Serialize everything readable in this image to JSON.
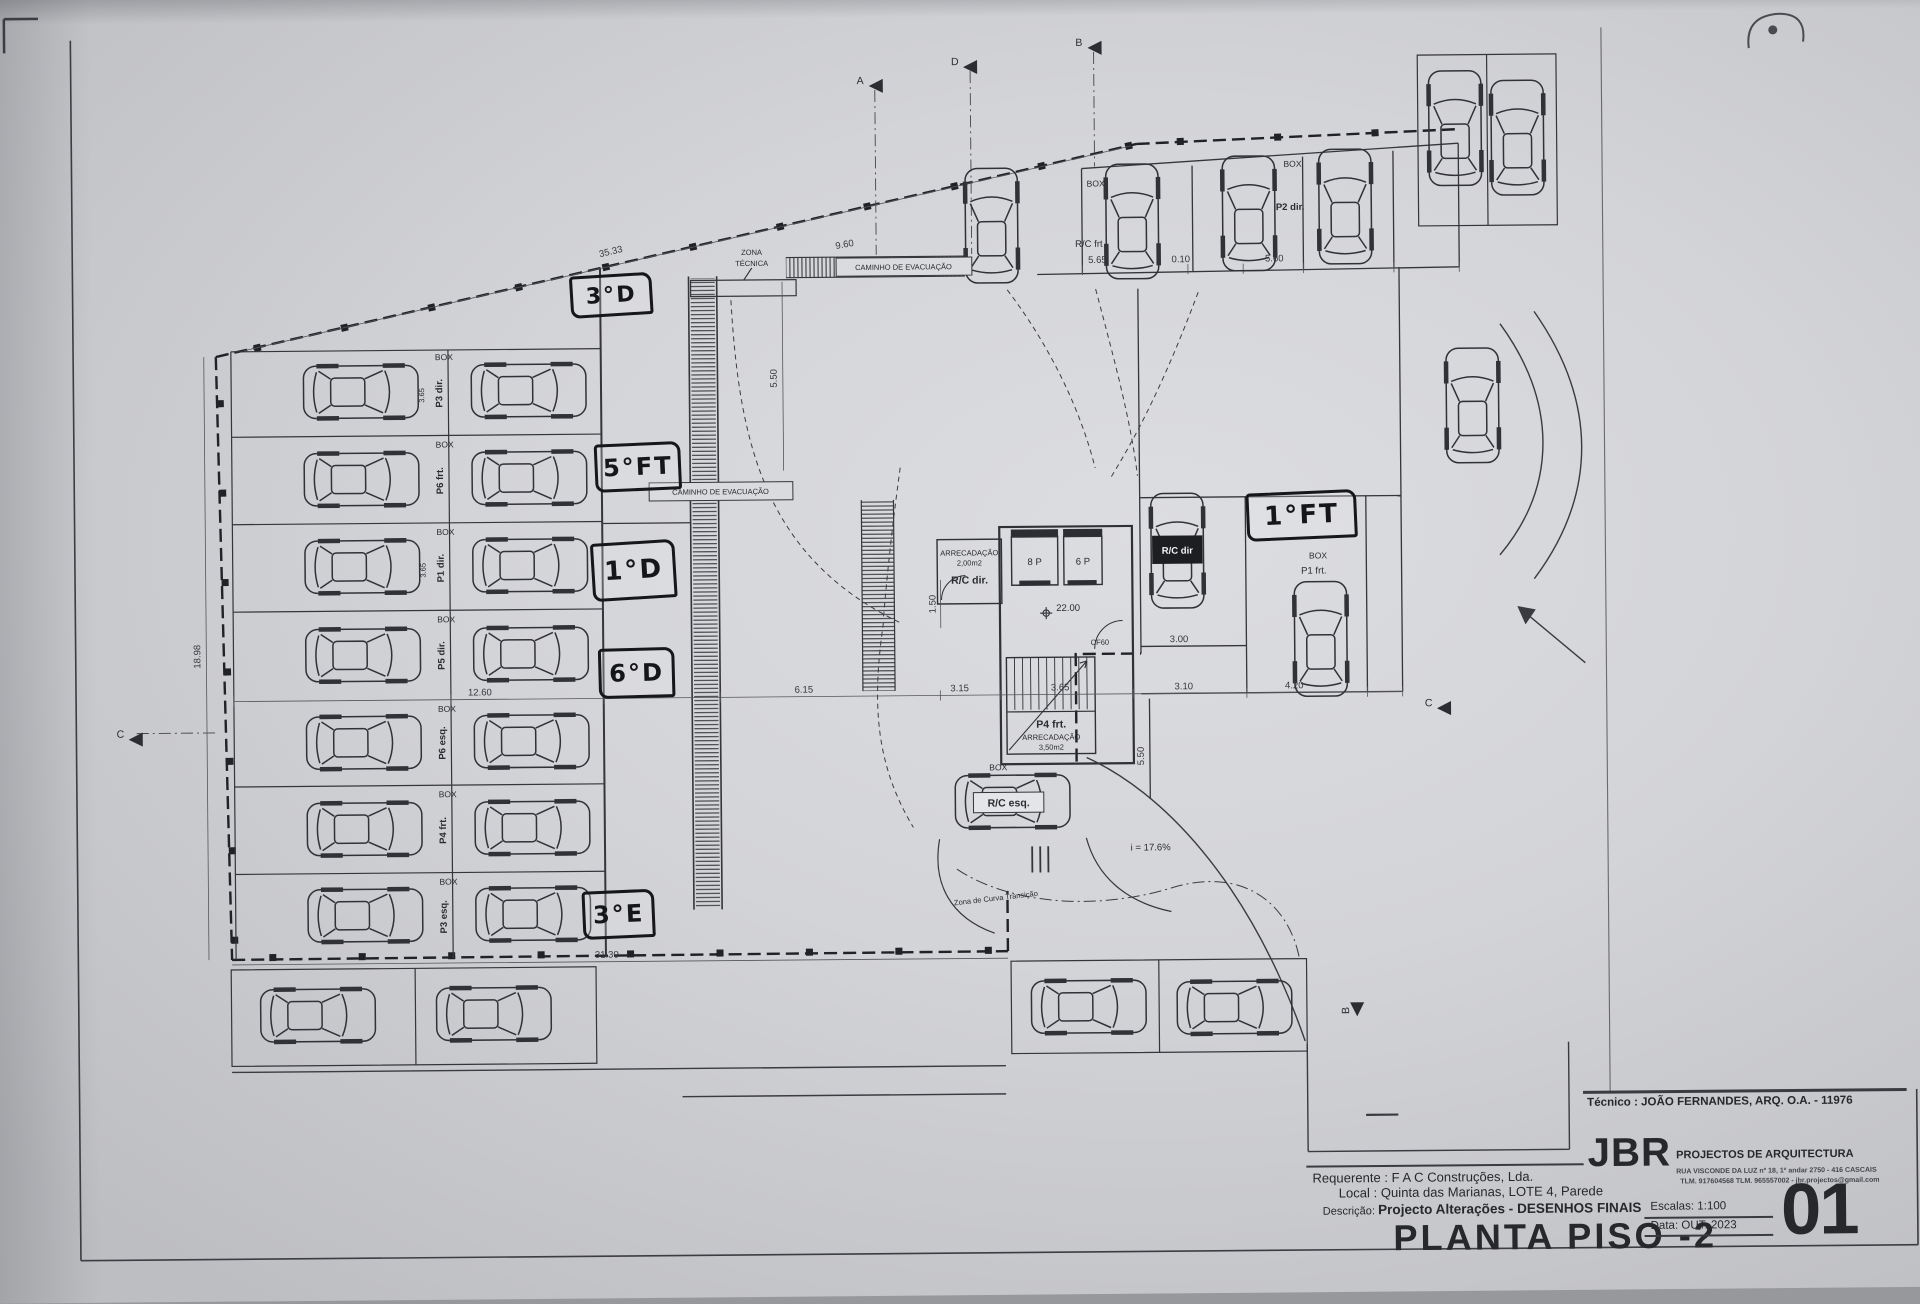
{
  "handwritten": {
    "top": "3°D",
    "mid1": "5°FT",
    "mid2": "1°D",
    "mid3": "6°D",
    "bottom": "3°E",
    "right": "1°FT"
  },
  "plan": {
    "box": "BOX",
    "stalls": [
      "P3 dir.",
      "P6 frt.",
      "P1 dir.",
      "P5 dir.",
      "P6 esq.",
      "P4 frt.",
      "P3 esq."
    ],
    "units": {
      "rc_frt": "R/C frt",
      "p2_dir": "P2 dir.",
      "rc_dir_car": "R/C dir",
      "rc_esq": "R/C esq.",
      "p1_frt": "P1 frt."
    },
    "core": {
      "lift1": "8 P",
      "lift2": "6 P",
      "store1": "ARRECADAÇÃO",
      "store1_area": "2,00m2",
      "store1_unit": "R/C dir.",
      "store2_unit": "P4 frt.",
      "store2": "ARRECADAÇÃO",
      "store2_area": "3,50m2",
      "level": "22.00",
      "door": "CF60"
    },
    "zones": {
      "zona1": "ZONA",
      "zona2": "TÉCNICA",
      "caminho": "CAMINHO DE EVACUAÇÃO",
      "curva": "Zona de Curva Transição",
      "slope": "i = 17.6%"
    },
    "dims": {
      "top_len": "35.33",
      "d960": "9.60",
      "d565": "5.65",
      "d010": "0.10",
      "d560": "5.60",
      "d1260": "12.60",
      "d615": "6.15",
      "d315": "3.15",
      "d365": "3.65",
      "d310": "3.10",
      "d420": "4.20",
      "left_h": "18.98",
      "d550a": "5.50",
      "d150": "1.50",
      "d300": "3.00",
      "d550b": "5.50",
      "bottom_len": "31.30",
      "row": "3.65"
    },
    "markers": {
      "a": "A",
      "b": "B",
      "c": "C",
      "d": "D"
    }
  },
  "titleblock": {
    "tecnico": "Técnico : JOÃO FERNANDES, ARQ.   O.A. - 11976",
    "brand": "JBR",
    "brand_sub": "PROJECTOS DE ARQUITECTURA",
    "addr1": "RUA VISCONDE DA LUZ nº 18, 1º andar  2750 - 416 CASCAIS",
    "addr2": "TLM. 917604568  TLM. 965557002 - jbr.projectos@gmail.com",
    "requerente_label": "Requerente :",
    "requerente": "F A C  Construções, Lda.",
    "local_label": "Local :",
    "local": "Quinta das Marianas, LOTE 4, Parede",
    "descricao_label": "Descrição:",
    "descricao": "Projecto Alterações - DESENHOS FINAIS",
    "title": "PLANTA PISO -2",
    "escala_label": "Escalas:",
    "escala": "1:100",
    "data_label": "Data:",
    "data": "OUT. 2023",
    "sheet": "01"
  }
}
